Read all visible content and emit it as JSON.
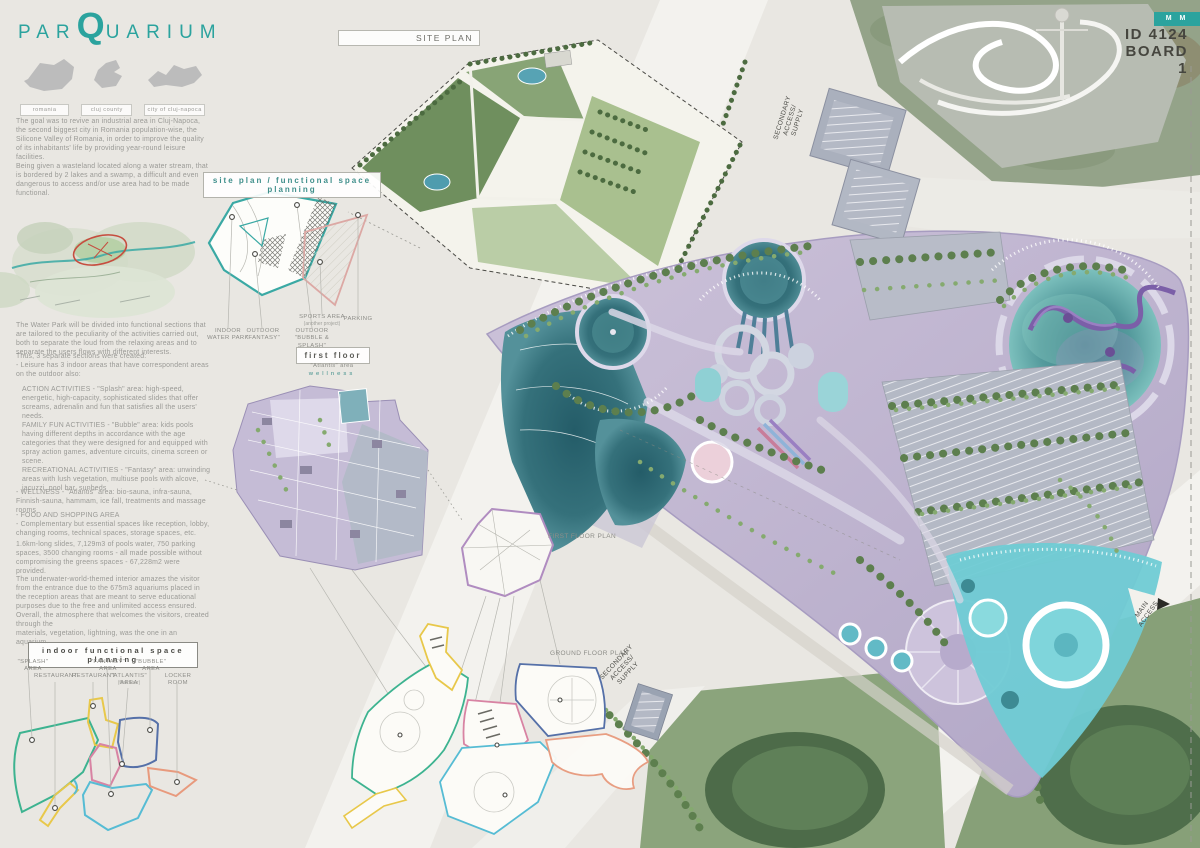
{
  "brand": {
    "logo_pre": "par",
    "logo_q": "Q",
    "logo_rest": "uarium"
  },
  "board_tag": {
    "chip": "M M",
    "id": "ID 4124",
    "board": "BOARD 1"
  },
  "maps": {
    "labels": [
      "romania",
      "cluj county",
      "city of cluj-napoca"
    ]
  },
  "text": {
    "intro": "The goal was to revive an industrial area in Cluj-Napoca, the second biggest city in Romania population-wise, the Silicone Valley of Romania, in order to improve the quality of its inhabitants' life by providing year-round leisure facilities.\nBeing given a wasteland located along a water stream, that is bordered by 2 lakes and a swamp, a difficult and even dangerous to access and/or use area had to be made functional.",
    "divide": "The Water Park will be divided into functional sections that are tailored to the peculiarity of the activities carried out, both to separate the loud from the relaxing areas and to separate the users flows with different interests.",
    "sections": "Thus, 3 separate sections were created:\n- Leisure has 3 indoor areas that have correspondent areas on the outdoor also:",
    "activities": "ACTION ACTIVITIES - \"Splash\" area: high-speed, energetic, high-capacity, sophisticated slides that offer screams, adrenalin and fun that satisfies all the users' needs.\nFAMILY FUN ACTIVITIES - \"Bubble\" area: kids pools having different depths in accordance with the age categories that they were designed for and equipped with spray action games, adventure circuits, cinema screen or scene.\nRECREATIONAL ACTIVITIES - \"Fantasy\" area: unwinding areas with lush vegetation, multiuse pools with alcove, jacuzzi, pool bar, sunbeds",
    "wellness": "- WELLNESS - \"Atlantis\" area: bio-sauna, infra-sauna, Finnish-sauna, hammam, ice fall, treatments and massage rooms",
    "food": "- FOOD AND SHOPPING AREA\n- Complementary but essential spaces like reception, lobby, changing rooms, technical spaces, storage spaces, etc.",
    "stats": "1.6km-long slides, 7,129m3 of pools water, 750 parking spaces, 3500 changing rooms - all made possible without compromising the greens spaces - 67,228m2 were provided.",
    "interior": "The underwater-world-themed interior amazes the visitor from the entrance due to the 675m3 aquariums placed in the reception areas that are meant to serve educational purposes due to the free and unlimited access ensured.\nOverall, the atmosphere that welcomes the visitors, created through the\nmaterials, vegetation, lightning, was the one in an aquarium."
  },
  "titles": {
    "site_plan": "SITE PLAN",
    "functional": "site plan / functional space planning",
    "first_floor": "first floor",
    "first_floor_sub": "\"Atlantis\" area",
    "first_floor_sub2": "wellness",
    "indoor_planning": "indoor functional space planning"
  },
  "functional_diagram": {
    "indoor": "INDOOR\nWATER PARK",
    "outdoor_fantasy": "OUTDOOR\n\"FANTASY\"",
    "outdoor_bubble": "OUTDOOR\n\"BUBBLE & SPLASH\"",
    "sports": "SPORTS AREA",
    "sports_sub": "(another project)",
    "parking": "PARKING"
  },
  "plan_labels": {
    "first_floor_plan": "FIRST FLOOR PLAN",
    "ground_floor_plan": "GROUND FLOOR PLAN",
    "secondary_access_top": "SECONDARY ACCESS/\nSUPPLY",
    "secondary_access_bottom": "SECONDARY ACCESS/\nSUPPLY",
    "main_access": "MAIN\nACCESS"
  },
  "legend": {
    "row1": [
      "\"SPLASH\" AREA",
      "\"FANTASY\" AREA",
      "\"BUBBLE\" AREA"
    ],
    "row2": [
      "RESTAURANT",
      "RESTAURANT",
      "\"ATLANTIS\" AREA",
      "LOCKER ROOM"
    ],
    "atlantis_sub": "(first floor)"
  },
  "colors": {
    "accent_teal": "#2ba39e",
    "splash_green": "#3db390",
    "fantasy_cyan": "#56bcd4",
    "bubble_navy": "#5570a8",
    "restaurant_yellow": "#e8c84a",
    "atlantis_pink": "#d883a3",
    "locker_salmon": "#e89a7d",
    "deck_lavender": "#beb3d1",
    "pool_teal": "#2e6e78"
  }
}
